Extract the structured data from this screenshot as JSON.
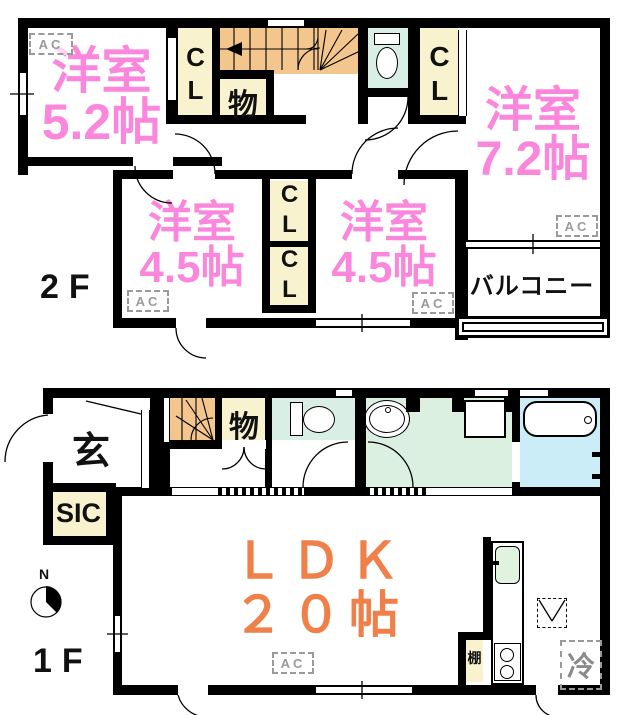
{
  "labels": {
    "ac": "AC",
    "north": "N"
  },
  "floor2": {
    "label": "2F",
    "room_52": {
      "name": "洋室",
      "size": "5.2帖"
    },
    "room_72": {
      "name": "洋室",
      "size": "7.2帖"
    },
    "room_45_left": {
      "name": "洋室",
      "size": "4.5帖"
    },
    "room_45_right": {
      "name": "洋室",
      "size": "4.5帖"
    },
    "balcony": "バルコニー",
    "closet": "CL",
    "storage": "物"
  },
  "floor1": {
    "label": "1F",
    "ldk": {
      "name": "ＬＤＫ",
      "size": "２０帖"
    },
    "entrance": "玄",
    "shoe_closet": "SIC",
    "storage": "物",
    "shelf": "棚",
    "refrigerator": "冷"
  },
  "colors": {
    "room_text_pink": "#FA87DC",
    "ldk_text_orange": "#F0804A",
    "stairs_orange": "#F3C68E",
    "closet_cream": "#F8F2CE",
    "toilet_mint": "#D9EFE6",
    "washroom_green": "#DCF0E2",
    "bath_cyan": "#CBEDF8"
  }
}
